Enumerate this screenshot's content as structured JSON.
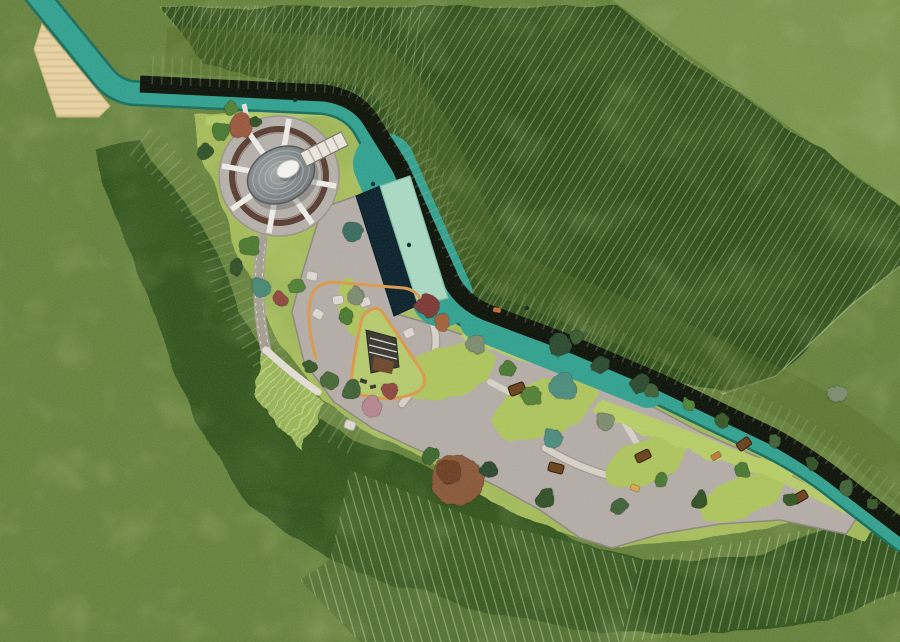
{
  "meta": {
    "kind": "landscape-site-plan",
    "canvas": {
      "width": 900,
      "height": 642
    }
  },
  "palette": {
    "grass_base": "#68833f",
    "grass_light": "#7d9750",
    "slope_dark": "#32511e",
    "slope_mid": "#546d2b",
    "fan_mid": "#46632b",
    "hatch_line": "#dce8c2",
    "stream": "#35a190",
    "stream_edge": "#1c6f60",
    "wall": "#11160d",
    "pool_water": "#0e2530",
    "pool_deck": "#a9d8c2",
    "entry_paving": "#e6d2a4",
    "entry_band": "#cdb382",
    "plaza": "#b4ada7",
    "plaza_edge": "#8f887f",
    "path": "#d9d4cb",
    "path_edge": "#a29b91",
    "lawn": "#a7bd5d",
    "lawn_bright": "#b7cd68",
    "amphi_lawn": "#9cb75a",
    "loop": "#d99a4e",
    "ring": "#5a4136",
    "disc": "#b6b0ab",
    "mound_light": "#a2a8a8",
    "mound_dark": "#6f7577",
    "egg": "#f3f2ee",
    "bench": "#6b451f",
    "bench_stroke": "#3a2410",
    "stone": "#dbd7d0",
    "stone_stroke": "#a8a298",
    "spoke": "#eceae5",
    "play_structure": "#3b3a32",
    "play_wood": "#6e4b2f"
  },
  "circle": {
    "cx": 279,
    "cy": 176,
    "r_outer": 60,
    "r_ring": 47,
    "r_spoke_inner": 16,
    "r_spoke_outer": 58,
    "spoke_angles_deg": [
      -80,
      -35,
      10,
      55,
      100,
      145,
      190,
      235
    ],
    "mound": {
      "cx": 281,
      "cy": 175,
      "rx": 35,
      "ry": 27,
      "rotation_deg": -28,
      "ring_scales": [
        0.84,
        0.66,
        0.48,
        0.31
      ]
    }
  },
  "trees": [
    {
      "x": 241,
      "y": 126,
      "r": 12,
      "color": "#9a5a3f"
    },
    {
      "x": 221,
      "y": 131,
      "r": 9,
      "color": "#4e7a34"
    },
    {
      "x": 206,
      "y": 152,
      "r": 8,
      "color": "#36522a"
    },
    {
      "x": 232,
      "y": 108,
      "r": 7,
      "color": "#55823a"
    },
    {
      "x": 257,
      "y": 121,
      "r": 6,
      "color": "#36522a"
    },
    {
      "x": 250,
      "y": 246,
      "r": 9,
      "color": "#4e7a34"
    },
    {
      "x": 237,
      "y": 266,
      "r": 8,
      "color": "#36522a"
    },
    {
      "x": 260,
      "y": 287,
      "r": 9,
      "color": "#4c8a77"
    },
    {
      "x": 281,
      "y": 300,
      "r": 8,
      "color": "#8f4b42"
    },
    {
      "x": 297,
      "y": 286,
      "r": 7,
      "color": "#55823a"
    },
    {
      "x": 352,
      "y": 232,
      "r": 10,
      "color": "#3e6e62"
    },
    {
      "x": 356,
      "y": 296,
      "r": 9,
      "color": "#7e8c70"
    },
    {
      "x": 345,
      "y": 316,
      "r": 7,
      "color": "#4e7a34"
    },
    {
      "x": 428,
      "y": 306,
      "r": 12,
      "color": "#7e3a38"
    },
    {
      "x": 442,
      "y": 322,
      "r": 8,
      "color": "#a3643c"
    },
    {
      "x": 560,
      "y": 345,
      "r": 11,
      "color": "#2f4d33"
    },
    {
      "x": 600,
      "y": 365,
      "r": 10,
      "color": "#2f4d33"
    },
    {
      "x": 640,
      "y": 385,
      "r": 9,
      "color": "#2f4d33"
    },
    {
      "x": 577,
      "y": 337,
      "r": 7,
      "color": "#3a5c30"
    },
    {
      "x": 562,
      "y": 387,
      "r": 13,
      "color": "#4f8d7e"
    },
    {
      "x": 553,
      "y": 438,
      "r": 10,
      "color": "#4f8d7e"
    },
    {
      "x": 476,
      "y": 344,
      "r": 10,
      "color": "#7e8c70"
    },
    {
      "x": 605,
      "y": 420,
      "r": 9,
      "color": "#7e8c70"
    },
    {
      "x": 838,
      "y": 394,
      "r": 9,
      "color": "#7e8c70"
    },
    {
      "x": 508,
      "y": 368,
      "r": 8,
      "color": "#4e7a34"
    },
    {
      "x": 530,
      "y": 396,
      "r": 9,
      "color": "#55823a"
    },
    {
      "x": 458,
      "y": 480,
      "r": 26,
      "color": "#8a5a3a"
    },
    {
      "x": 450,
      "y": 472,
      "r": 12,
      "color": "#6e4326"
    },
    {
      "x": 372,
      "y": 407,
      "r": 10,
      "color": "#b5888d"
    },
    {
      "x": 390,
      "y": 390,
      "r": 8,
      "color": "#8f4b42"
    },
    {
      "x": 352,
      "y": 390,
      "r": 9,
      "color": "#44633a"
    },
    {
      "x": 330,
      "y": 380,
      "r": 8,
      "color": "#4a6a38"
    },
    {
      "x": 310,
      "y": 366,
      "r": 7,
      "color": "#3a5a2c"
    },
    {
      "x": 430,
      "y": 455,
      "r": 9,
      "color": "#3f6a33"
    },
    {
      "x": 488,
      "y": 470,
      "r": 8,
      "color": "#2f4d33"
    },
    {
      "x": 545,
      "y": 498,
      "r": 9,
      "color": "#36522a"
    },
    {
      "x": 620,
      "y": 507,
      "r": 8,
      "color": "#44633a"
    },
    {
      "x": 700,
      "y": 500,
      "r": 8,
      "color": "#36522a"
    },
    {
      "x": 660,
      "y": 480,
      "r": 7,
      "color": "#4e7a34"
    },
    {
      "x": 652,
      "y": 390,
      "r": 7,
      "color": "#44633a"
    },
    {
      "x": 688,
      "y": 404,
      "r": 6,
      "color": "#55823a"
    },
    {
      "x": 722,
      "y": 420,
      "r": 7,
      "color": "#3a5a2c"
    },
    {
      "x": 775,
      "y": 442,
      "r": 7,
      "color": "#44633a"
    },
    {
      "x": 812,
      "y": 464,
      "r": 7,
      "color": "#36522a"
    },
    {
      "x": 848,
      "y": 488,
      "r": 7,
      "color": "#44633a"
    },
    {
      "x": 872,
      "y": 504,
      "r": 6,
      "color": "#3a5a2c"
    },
    {
      "x": 742,
      "y": 470,
      "r": 7,
      "color": "#4e7a34"
    },
    {
      "x": 790,
      "y": 500,
      "r": 7,
      "color": "#38592a"
    }
  ],
  "benches": [
    {
      "x": 517,
      "y": 389,
      "w": 16,
      "h": 10,
      "rot": -20
    },
    {
      "x": 556,
      "y": 468,
      "w": 15,
      "h": 9,
      "rot": 15
    },
    {
      "x": 643,
      "y": 456,
      "w": 15,
      "h": 9,
      "rot": -25
    },
    {
      "x": 800,
      "y": 497,
      "w": 15,
      "h": 9,
      "rot": -30
    },
    {
      "x": 744,
      "y": 444,
      "w": 14,
      "h": 9,
      "rot": -35
    }
  ],
  "stones": [
    {
      "x": 312,
      "y": 276,
      "rot": 12
    },
    {
      "x": 365,
      "y": 302,
      "rot": -18
    },
    {
      "x": 318,
      "y": 314,
      "rot": 30
    },
    {
      "x": 338,
      "y": 300,
      "rot": -8
    },
    {
      "x": 350,
      "y": 425,
      "rot": 20
    },
    {
      "x": 409,
      "y": 333,
      "rot": -25
    }
  ],
  "accents": [
    {
      "x": 635,
      "y": 488,
      "w": 9,
      "h": 6,
      "rot": 20,
      "color": "#d9a84e"
    },
    {
      "x": 716,
      "y": 456,
      "w": 10,
      "h": 6,
      "rot": -30,
      "color": "#c07a3a"
    },
    {
      "x": 497,
      "y": 310,
      "w": 8,
      "h": 5,
      "rot": 10,
      "color": "#c0703a"
    }
  ],
  "stream_dots": [
    {
      "x": 373,
      "y": 184
    },
    {
      "x": 409,
      "y": 245
    },
    {
      "x": 527,
      "y": 308
    },
    {
      "x": 295,
      "y": 100
    }
  ]
}
